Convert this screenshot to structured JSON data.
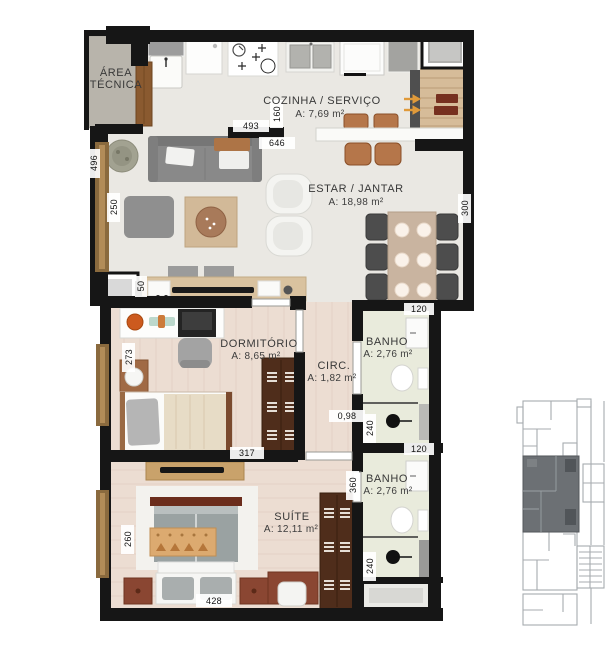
{
  "rooms": {
    "area_tecnica": {
      "lines": [
        "ÁREA",
        "TÉCNICA"
      ]
    },
    "cozinha": {
      "name": "COZINHA / SERVIÇO",
      "area": "A: 7,69 m²"
    },
    "estar": {
      "name": "ESTAR / JANTAR",
      "area": "A: 18,98 m²"
    },
    "dormitorio": {
      "name": "DORMITÓRIO",
      "area": "A: 8,65 m²"
    },
    "circ": {
      "name": "CIRC.",
      "area": "A: 1,82 m²"
    },
    "banho_superior": {
      "name": "BANHO",
      "area": "A: 2,76 m²"
    },
    "banho_inferior": {
      "name": "BANHO",
      "area": "A: 2,76 m²"
    },
    "suite": {
      "name": "SUÍTE",
      "area": "A: 12,11 m²"
    }
  },
  "dims": {
    "d493": "493",
    "d160": "160",
    "d646": "646",
    "d496": "496",
    "d250": "250",
    "d300": "300",
    "d50": "50",
    "d273": "273",
    "d120_sup": "120",
    "d098": "0,98",
    "d240_sup": "240",
    "d317": "317",
    "d120_inf": "120",
    "d360": "360",
    "d260": "260",
    "d240_inf": "240",
    "d428": "428"
  },
  "colors": {
    "wall": "#161616",
    "tile_floor": "#eae8e3",
    "wood_floor": "#ecddd2",
    "bath_floor": "#e9ebdc",
    "service_floor": "#b8b4ab",
    "entry_wood": "#d6bc99",
    "arrow_accent": "#e09a3a",
    "keyplan_line": "#a7abaf",
    "keyplan_highlight": "#6c7074"
  }
}
